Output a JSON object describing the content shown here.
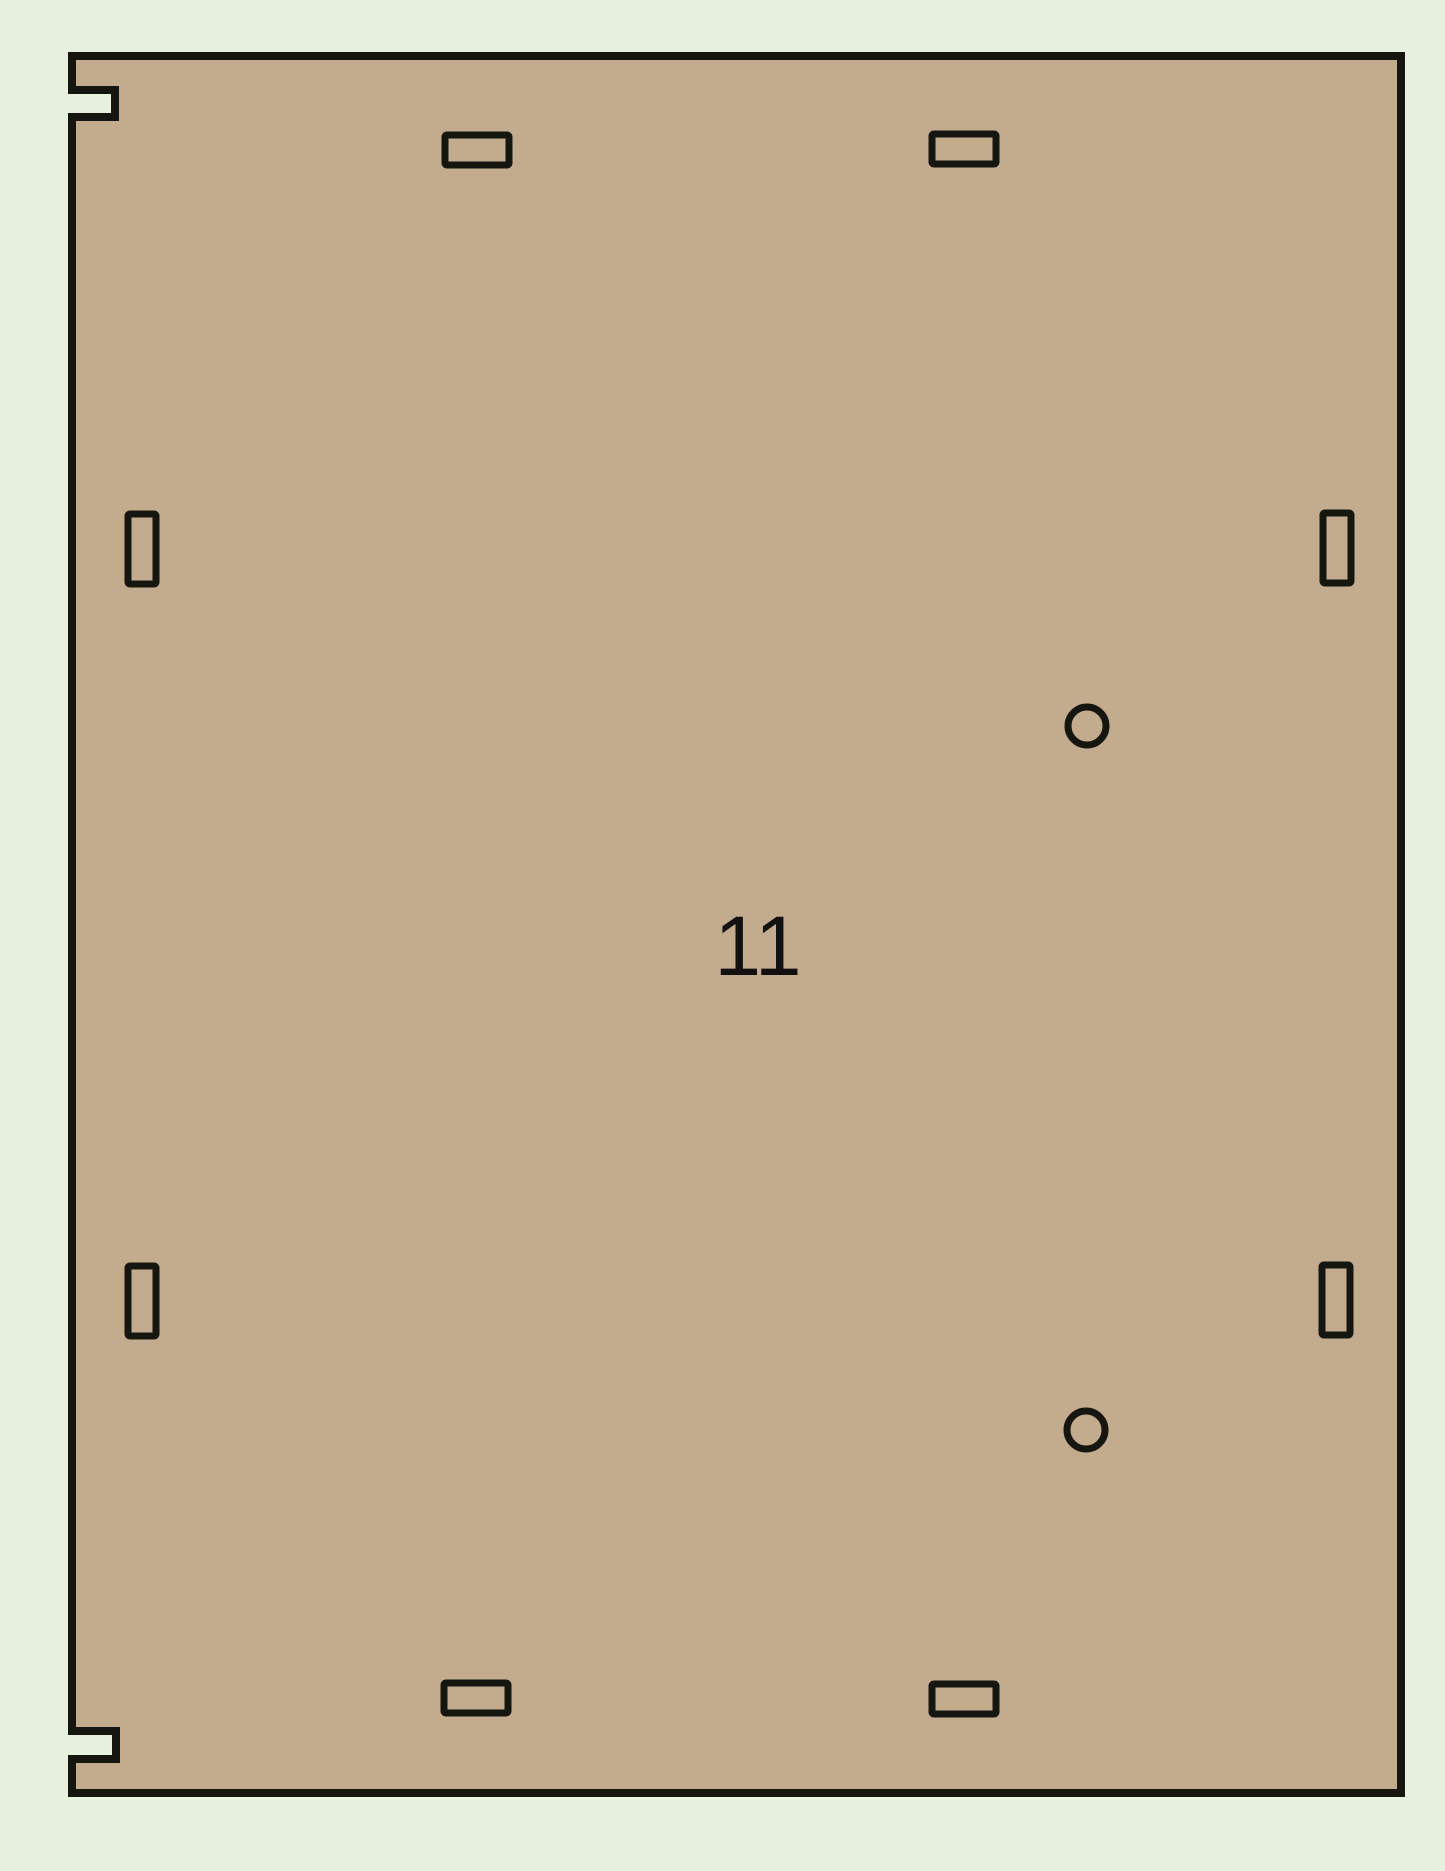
{
  "canvas": {
    "width": 1445,
    "height": 1871,
    "background_color": "#e7f1de"
  },
  "panel": {
    "label": "11",
    "fill_color": "#c3ab8e",
    "outline_color": "#161611",
    "outline_stroke_width": 8,
    "cut_stroke_width": 7,
    "outline": {
      "x": 72,
      "y": 56,
      "width": 1329,
      "height": 1737
    },
    "left_edge_notches": [
      {
        "name": "top-left-edge-notch",
        "y_top": 90,
        "y_bottom": 117,
        "depth": 43
      },
      {
        "name": "bottom-left-edge-notch",
        "y_top": 1731,
        "y_bottom": 1759,
        "depth": 44
      }
    ],
    "slots": [
      {
        "name": "top-slot-left",
        "x": 445,
        "y": 135,
        "width": 64,
        "height": 30
      },
      {
        "name": "top-slot-right",
        "x": 932,
        "y": 134,
        "width": 64,
        "height": 30
      },
      {
        "name": "left-slot-upper",
        "x": 128,
        "y": 514,
        "width": 28,
        "height": 70
      },
      {
        "name": "right-slot-upper",
        "x": 1323,
        "y": 513,
        "width": 28,
        "height": 70
      },
      {
        "name": "left-slot-lower",
        "x": 128,
        "y": 1266,
        "width": 28,
        "height": 70
      },
      {
        "name": "right-slot-lower",
        "x": 1322,
        "y": 1265,
        "width": 28,
        "height": 70
      },
      {
        "name": "bottom-slot-left",
        "x": 444,
        "y": 1683,
        "width": 64,
        "height": 30
      },
      {
        "name": "bottom-slot-right",
        "x": 932,
        "y": 1684,
        "width": 64,
        "height": 30
      }
    ],
    "holes": [
      {
        "name": "hole-upper",
        "cx": 1087,
        "cy": 726,
        "r": 19
      },
      {
        "name": "hole-lower",
        "cx": 1086,
        "cy": 1430,
        "r": 19
      }
    ],
    "label_position": {
      "x": 758,
      "y": 946
    },
    "label_font_size": 84,
    "label_color": "#111111"
  }
}
